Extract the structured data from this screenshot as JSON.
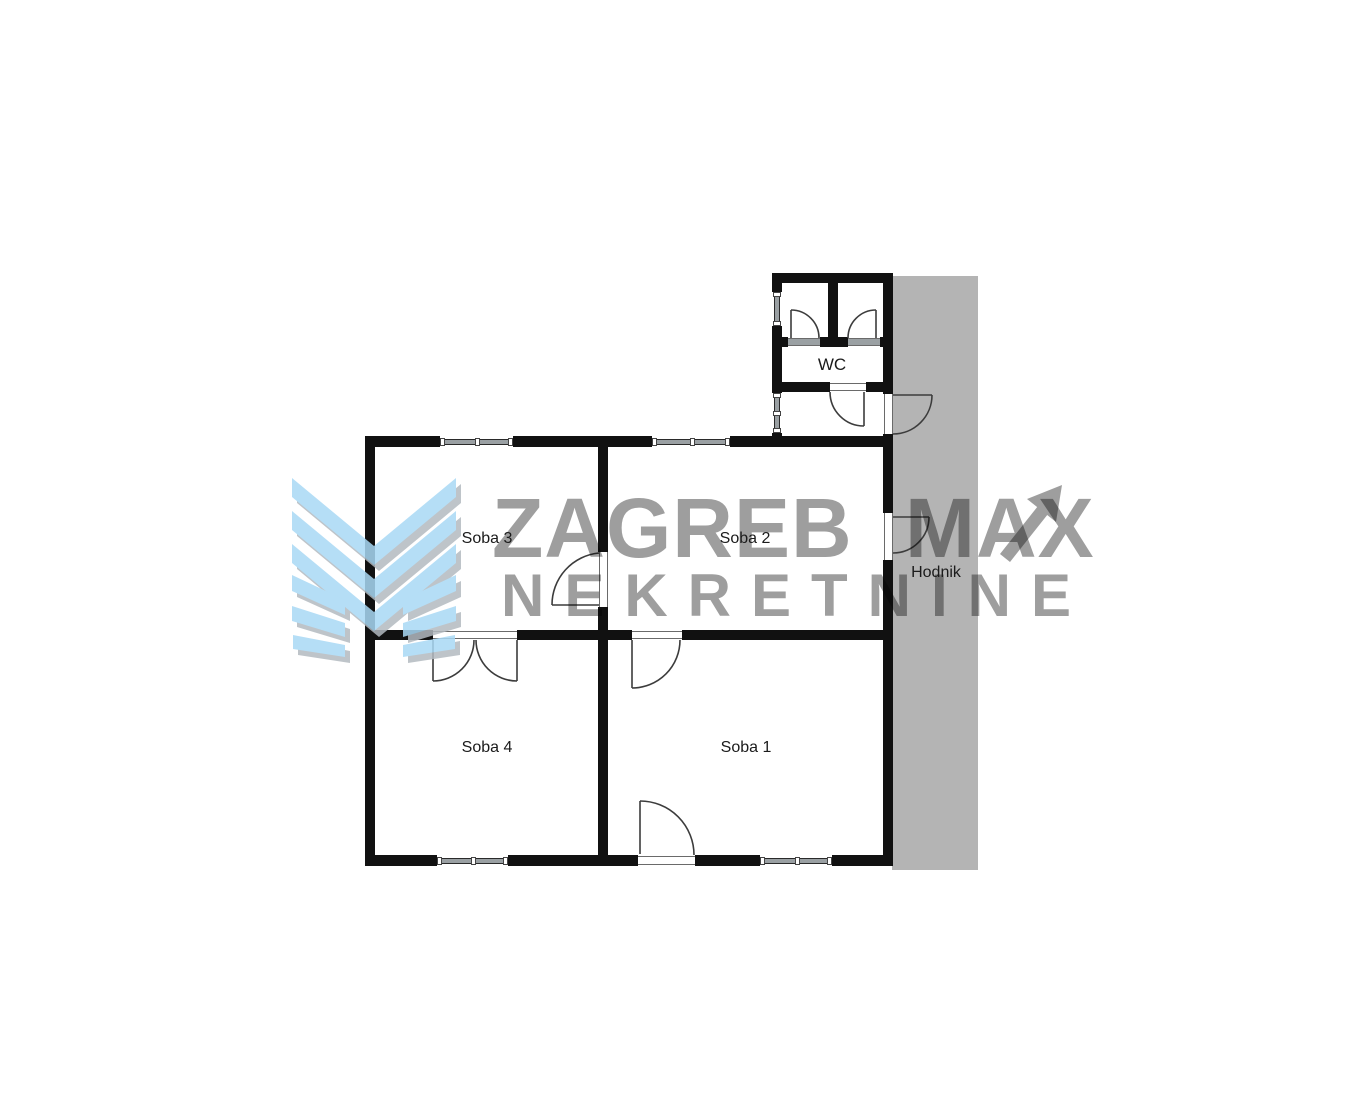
{
  "watermark": {
    "line1": "ZAGREB MAX",
    "line2": "NEKRETNINE"
  },
  "rooms": {
    "soba1": "Soba 1",
    "soba2": "Soba 2",
    "soba3": "Soba 3",
    "soba4": "Soba 4",
    "wc": "WC",
    "hodnik": "Hodnik"
  },
  "colors": {
    "hall_band": "#b4b4b4",
    "wall": "#111111",
    "watermark_text": "#9e9e9e",
    "logo_blue": "#a9d9f5",
    "logo_shadow": "#b3bac0"
  }
}
